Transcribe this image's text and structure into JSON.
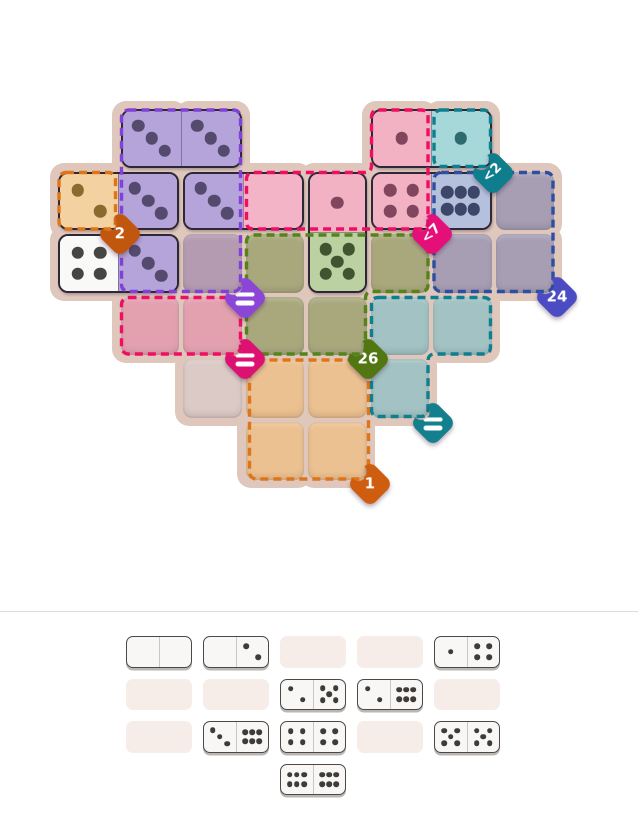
{
  "board": {
    "origin": {
      "x": 56,
      "y": 107
    },
    "cell_size": 62.5,
    "base_color": "#dfc7bb",
    "pip_size": 12.5,
    "pad_cells": [
      [
        1,
        0
      ],
      [
        2,
        0
      ],
      [
        5,
        0
      ],
      [
        6,
        0
      ],
      [
        0,
        1
      ],
      [
        1,
        1
      ],
      [
        2,
        1
      ],
      [
        3,
        1
      ],
      [
        4,
        1
      ],
      [
        5,
        1
      ],
      [
        6,
        1
      ],
      [
        7,
        1
      ],
      [
        0,
        2
      ],
      [
        1,
        2
      ],
      [
        2,
        2
      ],
      [
        3,
        2
      ],
      [
        4,
        2
      ],
      [
        5,
        2
      ],
      [
        6,
        2
      ],
      [
        7,
        2
      ],
      [
        1,
        3
      ],
      [
        2,
        3
      ],
      [
        3,
        3
      ],
      [
        4,
        3
      ],
      [
        5,
        3
      ],
      [
        6,
        3
      ],
      [
        2,
        4
      ],
      [
        3,
        4
      ],
      [
        4,
        4
      ],
      [
        5,
        4
      ],
      [
        3,
        5
      ],
      [
        4,
        5
      ]
    ],
    "empty_cells": [
      {
        "c": 2,
        "r": 2,
        "fill": "#b49bb1"
      },
      {
        "c": 7,
        "r": 1,
        "fill": "#a79eb4"
      },
      {
        "c": 6,
        "r": 2,
        "fill": "#a79eb4"
      },
      {
        "c": 7,
        "r": 2,
        "fill": "#a79eb4"
      },
      {
        "c": 3,
        "r": 2,
        "fill": "#a9a87d"
      },
      {
        "c": 5,
        "r": 2,
        "fill": "#a9a87d"
      },
      {
        "c": 3,
        "r": 3,
        "fill": "#a9a87d"
      },
      {
        "c": 4,
        "r": 3,
        "fill": "#a9a87d"
      },
      {
        "c": 1,
        "r": 3,
        "fill": "#e3a1b0"
      },
      {
        "c": 2,
        "r": 3,
        "fill": "#e3a1b0"
      },
      {
        "c": 5,
        "r": 3,
        "fill": "#a2c2c3"
      },
      {
        "c": 6,
        "r": 3,
        "fill": "#a2c2c3"
      },
      {
        "c": 5,
        "r": 4,
        "fill": "#a2c2c3"
      },
      {
        "c": 2,
        "r": 4,
        "fill": "#dccac6"
      },
      {
        "c": 3,
        "r": 4,
        "fill": "#ecc191"
      },
      {
        "c": 4,
        "r": 4,
        "fill": "#ecc191"
      },
      {
        "c": 3,
        "r": 5,
        "fill": "#ecc191"
      },
      {
        "c": 4,
        "r": 5,
        "fill": "#ecc191"
      }
    ],
    "dominoes": [
      {
        "c": 1,
        "r": 0,
        "dir": "h",
        "pips": [
          3,
          3
        ],
        "fills": [
          "#b5a4d9",
          "#b5a4d9"
        ],
        "pip_colors": [
          "#544a6e",
          "#544a6e"
        ]
      },
      {
        "c": 5,
        "r": 0,
        "dir": "h",
        "pips": [
          1,
          1
        ],
        "fills": [
          "#f3b1c4",
          "#a6d7d9"
        ],
        "pip_colors": [
          "#81465d",
          "#2e6b6e"
        ]
      },
      {
        "c": 0,
        "r": 1,
        "dir": "h",
        "pips": [
          2,
          3
        ],
        "fills": [
          "#f3d1a0",
          "#b5a4d9"
        ],
        "pip_colors": [
          "#8a6b2e",
          "#544a6e"
        ]
      },
      {
        "c": 2,
        "r": 1,
        "dir": "h",
        "pips": [
          3,
          0
        ],
        "fills": [
          "#b5a4d9",
          "#f4b4c7"
        ],
        "pip_colors": [
          "#544a6e",
          "#81465d"
        ]
      },
      {
        "c": 5,
        "r": 1,
        "dir": "h",
        "pips": [
          4,
          6
        ],
        "fills": [
          "#f3b1c4",
          "#b5c0dd"
        ],
        "pip_colors": [
          "#81465d",
          "#3d4568"
        ]
      },
      {
        "c": 4,
        "r": 1,
        "dir": "v",
        "pips": [
          1,
          5
        ],
        "fills": [
          "#f3b1c4",
          "#bcd1a2"
        ],
        "pip_colors": [
          "#81465d",
          "#40552f"
        ]
      },
      {
        "c": 0,
        "r": 2,
        "dir": "h",
        "pips": [
          4,
          3
        ],
        "fills": [
          "#f9f9f8",
          "#b5a4d9"
        ],
        "pip_colors": [
          "#474544",
          "#544a6e"
        ]
      }
    ],
    "regions": [
      {
        "name": "orange-2",
        "label": "2",
        "shape": "rect",
        "x": 59,
        "y": 172.5,
        "w": 56.5,
        "h": 56.5,
        "dash": "#df7519",
        "badge": {
          "cx": 119.5,
          "cy": 233.5,
          "color": "#c1560e",
          "rotated": false
        }
      },
      {
        "name": "purple-equal",
        "label": "=",
        "shape": "rect",
        "x": 121.5,
        "y": 110,
        "w": 119,
        "h": 181.5,
        "dash": "#8140d8",
        "badge": {
          "cx": 245,
          "cy": 298,
          "color": "#8b46d8",
          "rotated": false
        }
      },
      {
        "name": "teal-lt2",
        "label": "<2",
        "shape": "rect",
        "x": 434,
        "y": 110,
        "w": 56.5,
        "h": 56.5,
        "dash": "#0f7f8f",
        "badge": {
          "cx": 493,
          "cy": 173,
          "color": "#0e7e8d",
          "rotated": true
        }
      },
      {
        "name": "blue-24",
        "label": "24",
        "shape": "rect",
        "x": 434,
        "y": 172.5,
        "w": 119,
        "h": 119,
        "dash": "#2d4fa1",
        "badge": {
          "cx": 557,
          "cy": 297,
          "color": "#4b4cc3",
          "rotated": false
        }
      },
      {
        "name": "pink-equal",
        "label": "=",
        "shape": "rect",
        "x": 121.5,
        "y": 297.5,
        "w": 119,
        "h": 56.5,
        "dash": "#ef0f62",
        "badge": {
          "cx": 245,
          "cy": 359,
          "color": "#dc1172",
          "rotated": false
        }
      },
      {
        "name": "orange-1",
        "label": "1",
        "shape": "rect",
        "x": 249.5,
        "y": 360,
        "w": 119,
        "h": 119,
        "dash": "#df7519",
        "badge": {
          "cx": 369.5,
          "cy": 484,
          "color": "#cf5d10",
          "rotated": false
        }
      },
      {
        "name": "pink-lt7",
        "label": "<7",
        "shape": "path",
        "d": "M 378.5 110 L 421 110 Q 428 110 428 117 L 428 222 Q 428 229 421 229 L 253.5 229 Q 246.5 229 246.5 222 L 246.5 179.5 Q 246.5 172.5 253.5 172.5 L 364.5 172.5 Q 371.5 172.5 371.5 165.5 L 371.5 117 Q 371.5 110 378.5 110 Z",
        "dash": "#ef0f62",
        "badge": {
          "cx": 432,
          "cy": 234,
          "color": "#e40f79",
          "rotated": true
        }
      },
      {
        "name": "green-26",
        "label": "26",
        "shape": "path",
        "d": "M 253.5 235 L 421 235 Q 428 235 428 242 L 428 284.5 Q 428 291.5 421 291.5 L 372.5 291.5 Q 365.5 291.5 365.5 298.5 L 365.5 347 Q 365.5 354 358.5 354 L 253.5 354 Q 246.5 354 246.5 347 L 246.5 242 Q 246.5 235 253.5 235 Z",
        "dash": "#55831a",
        "badge": {
          "cx": 368,
          "cy": 359,
          "color": "#527712",
          "rotated": false
        }
      },
      {
        "name": "teal-equal",
        "label": "=",
        "shape": "path",
        "d": "M 378.5 297.5 L 483.5 297.5 Q 490.5 297.5 490.5 304.5 L 490.5 347 Q 490.5 354 483.5 354 L 435 354 Q 428 354 428 361 L 428 409.5 Q 428 416.5 421 416.5 L 378.5 416.5 Q 371.5 416.5 371.5 409.5 L 371.5 304.5 Q 371.5 297.5 378.5 297.5 Z",
        "dash": "#0f7f8f",
        "badge": {
          "cx": 433,
          "cy": 423,
          "color": "#14808e",
          "rotated": false
        }
      }
    ]
  },
  "tray": {
    "divider_y": 611,
    "divider_color": "#dcdcdc",
    "slot_xs": [
      126,
      203,
      280,
      357,
      434
    ],
    "row_ys": [
      636,
      678.5,
      721,
      763.5
    ],
    "empty_fill": "#f6ede9",
    "pip_color": "#3e3b39",
    "pip_size": 5.6,
    "rows": [
      [
        {
          "t": "d",
          "pips": [
            0,
            0
          ]
        },
        {
          "t": "d",
          "pips": [
            0,
            2
          ]
        },
        {
          "t": "e"
        },
        {
          "t": "e"
        },
        {
          "t": "d",
          "pips": [
            1,
            4
          ]
        }
      ],
      [
        {
          "t": "e"
        },
        {
          "t": "e"
        },
        {
          "t": "d",
          "pips": [
            2,
            5
          ]
        },
        {
          "t": "d",
          "pips": [
            2,
            6
          ]
        },
        {
          "t": "e"
        }
      ],
      [
        {
          "t": "e"
        },
        {
          "t": "d",
          "pips": [
            3,
            6
          ]
        },
        {
          "t": "d",
          "pips": [
            4,
            4
          ]
        },
        {
          "t": "e"
        },
        {
          "t": "d",
          "pips": [
            5,
            5
          ]
        }
      ],
      [
        {
          "t": "n"
        },
        {
          "t": "n"
        },
        {
          "t": "d",
          "pips": [
            6,
            6
          ]
        },
        {
          "t": "n"
        },
        {
          "t": "n"
        }
      ]
    ]
  },
  "pip_layouts": {
    "0": [],
    "1": [
      [
        50,
        50
      ]
    ],
    "2": [
      [
        31,
        31
      ],
      [
        69,
        69
      ]
    ],
    "3": [
      [
        27,
        27
      ],
      [
        50,
        50
      ],
      [
        73,
        73
      ]
    ],
    "4": [
      [
        31,
        31
      ],
      [
        69,
        31
      ],
      [
        31,
        69
      ],
      [
        69,
        69
      ]
    ],
    "5": [
      [
        29,
        29
      ],
      [
        71,
        29
      ],
      [
        50,
        50
      ],
      [
        29,
        71
      ],
      [
        71,
        71
      ]
    ],
    "6": [
      [
        27,
        34
      ],
      [
        50,
        34
      ],
      [
        73,
        34
      ],
      [
        27,
        66
      ],
      [
        50,
        66
      ],
      [
        73,
        66
      ]
    ]
  }
}
